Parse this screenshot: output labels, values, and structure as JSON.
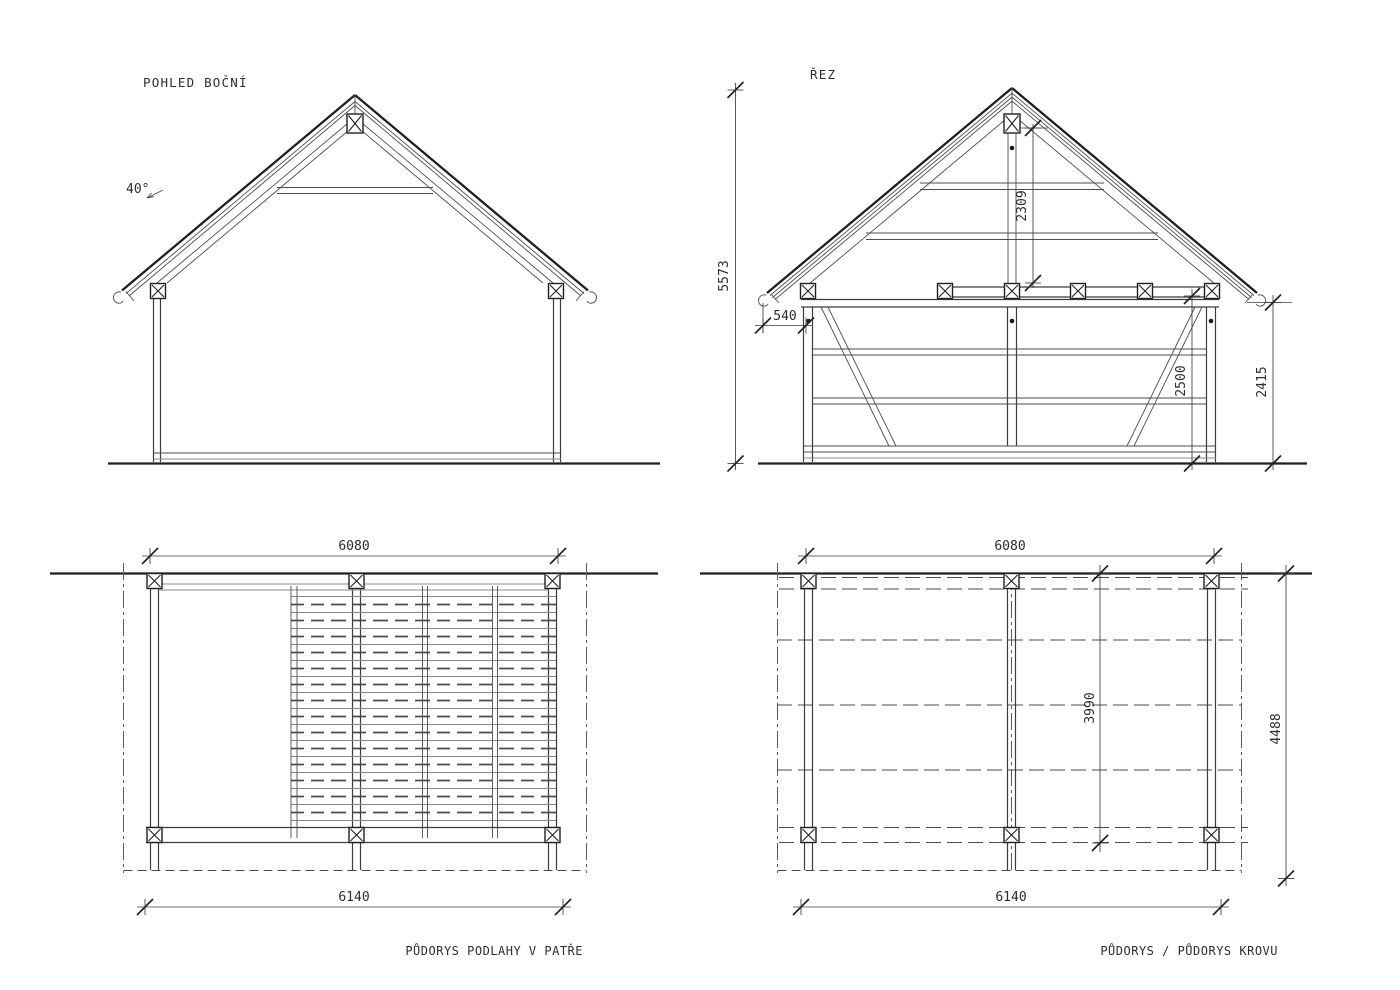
{
  "palette": {
    "background": "#ffffff",
    "line_dark": "#1f1f1f",
    "line_medium": "#3c3c3c",
    "line_light": "#8b8b8b",
    "text": "#2d2d2d"
  },
  "views": {
    "side_view": {
      "title": "POHLED BOČNÍ",
      "roof_angle": "40°"
    },
    "section": {
      "title": "ŘEZ",
      "dims": {
        "total_height": "5573",
        "ridge_to_plate": "2309",
        "eave_overhang": "540",
        "frame_height": "2500",
        "eave_height": "2415"
      }
    },
    "floor_plan": {
      "title": "PŮDORYS PODLAHY V PATŘE",
      "dims": {
        "width_top": "6080",
        "width_bottom": "6140"
      }
    },
    "roof_plan": {
      "title": "PŮDORYS / PŮDORYS KROVU",
      "dims": {
        "width_top": "6080",
        "width_bottom": "6140",
        "depth_inner": "3990",
        "depth_outer": "4488"
      }
    }
  }
}
